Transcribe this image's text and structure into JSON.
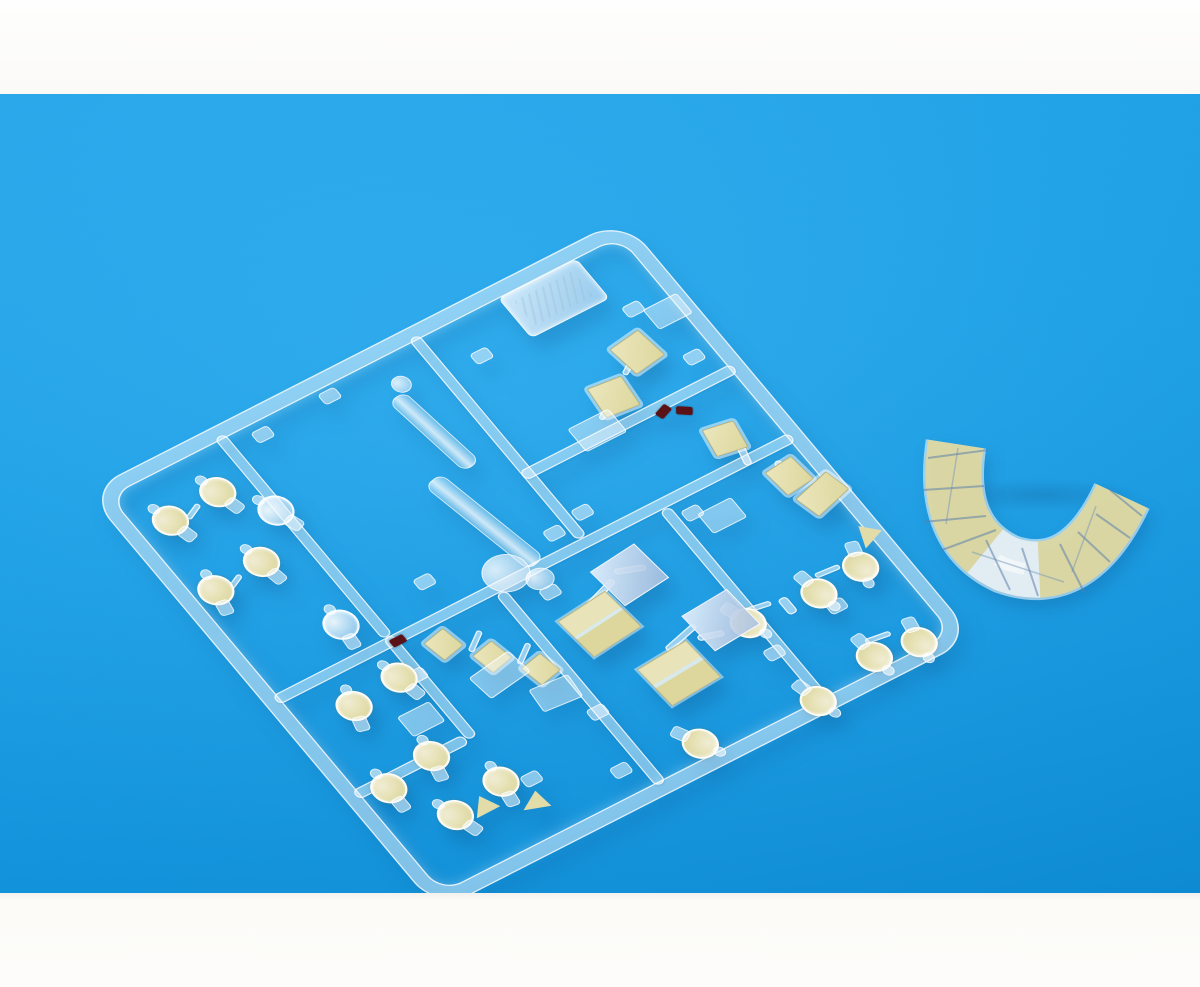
{
  "scene": {
    "description": "Photo of a clear injection-molded model kit sprue with pale-yellow paint masks applied to lamp lenses and window parts, lying on a bright azure background; a separately molded wrap-around canopy section with yellow masked panels sits to the right; white photo borders at top and bottom; an embossed illegible maker tag is molded near the sprue's top corner; three tiny dark-red painted parts sit near runner junctions.",
    "background": {
      "page_white": "#fdfcfa",
      "blue_top": "#23aaf0",
      "blue_mid": "#17a1ea",
      "blue_bottom": "#0d90da",
      "photo_area_top": 94,
      "photo_area_bottom": 893
    },
    "palette": {
      "mask_yellow": "#e4dfaa",
      "mask_yellow_dark": "#d7d194",
      "mask_border": "#968c50",
      "clear_plastic": "rgba(243,250,255,0.46)",
      "clear_edge": "rgba(255,255,255,0.85)",
      "window_blue": "#b8c8e2",
      "red_paint": "#5a1216",
      "shadow_blue": "rgba(8,70,125,0.26)"
    },
    "counts": {
      "masked_lamps": 17,
      "clear_lamps": 2,
      "masked_squares": 7,
      "masked_panels": 2,
      "clear_panels": 2,
      "masked_wedges": 3,
      "red_painted_parts": 3
    },
    "sprue": {
      "x": 88,
      "y": 398,
      "width": 600,
      "height": 545,
      "matrix": [
        0.891,
        -0.454,
        0.643,
        0.766
      ],
      "frame_thickness": 13,
      "corner_radius": 36,
      "runners": [
        {
          "x": 134,
          "y": 10,
          "w": 12,
          "h": 262
        },
        {
          "x": 134,
          "y": 272,
          "w": 12,
          "h": 132
        },
        {
          "x": 352,
          "y": 10,
          "w": 12,
          "h": 262
        },
        {
          "x": 352,
          "y": 182,
          "w": 238,
          "h": 12
        },
        {
          "x": 10,
          "y": 272,
          "w": 580,
          "h": 12
        },
        {
          "x": 252,
          "y": 284,
          "w": 12,
          "h": 250
        },
        {
          "x": 436,
          "y": 284,
          "w": 12,
          "h": 250
        },
        {
          "x": 10,
          "y": 396,
          "w": 124,
          "h": 12
        }
      ],
      "links": [
        [
          497,
          133,
          26,
          6,
          -32
        ],
        [
          449,
          163,
          26,
          6,
          -32
        ],
        [
          536,
          262,
          8,
          22,
          15
        ],
        [
          556,
          292,
          8,
          20,
          15
        ],
        [
          316,
          328,
          40,
          7,
          -18
        ],
        [
          360,
          320,
          30,
          7,
          20
        ],
        [
          350,
          406,
          40,
          7,
          -14
        ],
        [
          382,
          418,
          26,
          7,
          16
        ],
        [
          193,
          314,
          26,
          6,
          -35
        ],
        [
          223,
          348,
          26,
          6,
          -35
        ],
        [
          60,
          64,
          20,
          6,
          -25
        ],
        [
          46,
          148,
          20,
          6,
          -25
        ],
        [
          434,
          414,
          30,
          6,
          10
        ],
        [
          516,
          414,
          26,
          6,
          5
        ],
        [
          512,
          498,
          26,
          6,
          8
        ],
        [
          470,
          420,
          10,
          20,
          0
        ]
      ],
      "studs": [
        [
          166,
          22
        ],
        [
          244,
          18
        ],
        [
          390,
          52
        ],
        [
          540,
          80
        ],
        [
          366,
          242
        ],
        [
          452,
          294
        ],
        [
          128,
          314
        ],
        [
          246,
          432
        ],
        [
          424,
          460
        ],
        [
          504,
          446
        ],
        [
          150,
          462
        ],
        [
          226,
          496
        ],
        [
          556,
          152
        ],
        [
          330,
          248
        ],
        [
          196,
          232
        ],
        [
          288,
          300
        ]
      ],
      "parts": [
        {
          "t": "lamp",
          "x": 28,
          "y": 44,
          "r": -15,
          "masked": true
        },
        {
          "t": "lamp",
          "x": 84,
          "y": 40,
          "r": -15,
          "masked": true
        },
        {
          "t": "lamp",
          "x": 16,
          "y": 128,
          "r": 10,
          "masked": true
        },
        {
          "t": "lamp",
          "x": 72,
          "y": 124,
          "r": -10,
          "masked": true
        },
        {
          "t": "lamp",
          "x": 118,
          "y": 84,
          "r": -20,
          "masked": false
        },
        {
          "t": "lamp",
          "x": 92,
          "y": 218,
          "r": 5,
          "masked": false
        },
        {
          "t": "lamp",
          "x": 48,
          "y": 298,
          "r": 15,
          "masked": true
        },
        {
          "t": "lamp",
          "x": 104,
          "y": 294,
          "r": -12,
          "masked": true
        },
        {
          "t": "lamp",
          "x": 22,
          "y": 390,
          "r": 0,
          "masked": true
        },
        {
          "t": "lamp",
          "x": 76,
          "y": 380,
          "r": 12,
          "masked": true
        },
        {
          "t": "lamp",
          "x": 58,
          "y": 446,
          "r": -18,
          "masked": true
        },
        {
          "t": "lamp",
          "x": 114,
          "y": 436,
          "r": 8,
          "masked": true
        },
        {
          "t": "lamp",
          "x": 298,
          "y": 486,
          "r": 150,
          "masked": true
        },
        {
          "t": "lamp",
          "x": 416,
          "y": 398,
          "r": 160,
          "masked": true
        },
        {
          "t": "lamp",
          "x": 492,
          "y": 404,
          "r": 170,
          "masked": true
        },
        {
          "t": "lamp",
          "x": 544,
          "y": 400,
          "r": 195,
          "masked": true
        },
        {
          "t": "lamp",
          "x": 420,
          "y": 502,
          "r": 165,
          "masked": true
        },
        {
          "t": "lamp",
          "x": 494,
          "y": 488,
          "r": 175,
          "masked": true
        },
        {
          "t": "lamp",
          "x": 540,
          "y": 496,
          "r": 190,
          "masked": true
        },
        {
          "t": "sq",
          "s": 34,
          "x": 506,
          "y": 110,
          "r": -8
        },
        {
          "t": "sq",
          "s": 34,
          "x": 458,
          "y": 140,
          "r": 6
        },
        {
          "t": "sq",
          "s": 30,
          "x": 520,
          "y": 232,
          "r": 10
        },
        {
          "t": "sq",
          "s": 30,
          "x": 546,
          "y": 296,
          "r": -6
        },
        {
          "t": "sq",
          "s": 24,
          "x": 166,
          "y": 292,
          "r": -12
        },
        {
          "t": "sq",
          "s": 24,
          "x": 196,
          "y": 326,
          "r": -12
        },
        {
          "t": "sq",
          "s": 24,
          "x": 226,
          "y": 360,
          "r": -12
        },
        {
          "t": "rm",
          "x": 554,
          "y": 330,
          "r": -15
        },
        {
          "t": "rc",
          "x": 418,
          "y": 166,
          "w": 44,
          "h": 28,
          "r": 0
        },
        {
          "t": "rc",
          "x": 556,
          "y": 92,
          "w": 36,
          "h": 24,
          "r": 0
        },
        {
          "t": "rc",
          "x": 178,
          "y": 344,
          "w": 48,
          "h": 28,
          "r": -8
        },
        {
          "t": "rc",
          "x": 214,
          "y": 388,
          "w": 40,
          "h": 26,
          "r": 5
        },
        {
          "t": "rc",
          "x": 94,
          "y": 350,
          "w": 34,
          "h": 24,
          "r": 0
        },
        {
          "t": "rc",
          "x": 464,
          "y": 304,
          "w": 36,
          "h": 24,
          "r": 0
        },
        {
          "t": "pm",
          "x": 286,
          "y": 334,
          "r": -6
        },
        {
          "t": "pm",
          "x": 316,
          "y": 416,
          "r": -4
        },
        {
          "t": "pc",
          "x": 344,
          "y": 304,
          "r": -6
        },
        {
          "t": "pc",
          "x": 386,
          "y": 388,
          "r": -4
        },
        {
          "t": "wedge",
          "x": 92,
          "y": 460,
          "r": 10
        },
        {
          "t": "wedge",
          "x": 136,
          "y": 480,
          "r": 30
        },
        {
          "t": "wedge",
          "x": 572,
          "y": 390,
          "r": -10
        },
        {
          "t": "tag",
          "x": 450,
          "y": 14,
          "r": 0
        },
        {
          "t": "cylbar",
          "x": 302,
          "y": 56,
          "w": 18,
          "h": 98,
          "r": -8
        },
        {
          "t": "cylbar",
          "x": 281,
          "y": 148,
          "w": 20,
          "h": 126,
          "r": -12
        },
        {
          "t": "blob",
          "x": 308,
          "y": 38,
          "w": 17,
          "h": 17
        },
        {
          "t": "blob",
          "x": 252,
          "y": 248,
          "w": 44,
          "h": 40
        },
        {
          "t": "blob",
          "x": 284,
          "y": 278,
          "w": 26,
          "h": 22
        },
        {
          "t": "red",
          "x": 498,
          "y": 190,
          "r": -20
        },
        {
          "t": "red",
          "x": 515,
          "y": 199,
          "r": 35
        },
        {
          "t": "red",
          "x": 138,
          "y": 276,
          "r": 0
        }
      ]
    },
    "canopy": {
      "x": 896,
      "y": 298,
      "width": 300,
      "height": 230,
      "path": "M60,52 Q46,142 110,172 Q182,198 226,104",
      "band_width": 56,
      "rim_width": 61,
      "fill": "#ddd7a0",
      "clear_from": 40,
      "clear_len": 20,
      "dividers": [
        [
          32,
          66,
          92,
          58
        ],
        [
          27,
          98,
          88,
          94
        ],
        [
          27,
          130,
          90,
          124
        ],
        [
          46,
          158,
          100,
          138
        ],
        [
          90,
          148,
          114,
          198
        ],
        [
          126,
          156,
          142,
          204
        ],
        [
          164,
          152,
          188,
          200
        ],
        [
          182,
          140,
          214,
          170
        ],
        [
          200,
          122,
          234,
          146
        ],
        [
          214,
          98,
          246,
          124
        ]
      ],
      "ridges": [
        [
          62,
          56,
          50,
          132
        ],
        [
          76,
          160,
          168,
          190
        ],
        [
          200,
          114,
          176,
          180
        ]
      ],
      "shadow": {
        "x": 940,
        "y": 478,
        "w": 200,
        "h": 34
      }
    }
  }
}
